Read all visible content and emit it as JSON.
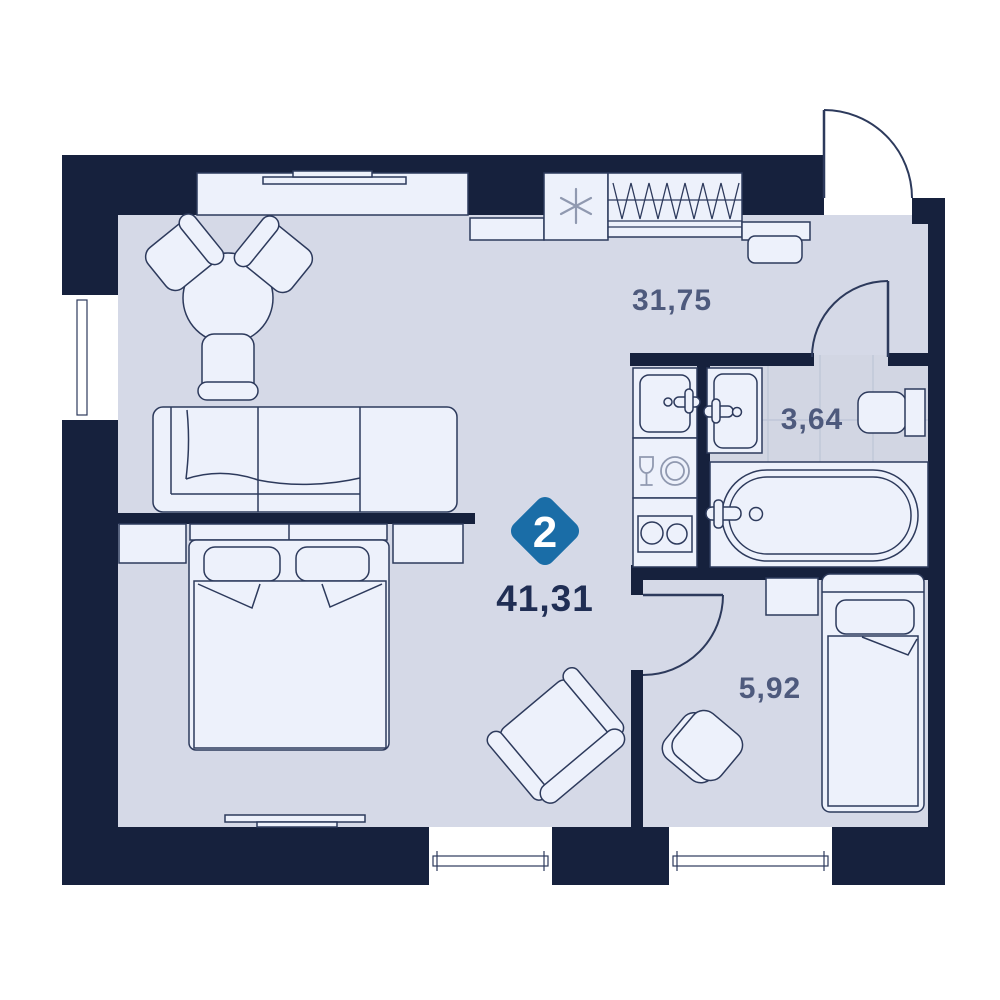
{
  "title": "2-room apartment floor plan",
  "badge": {
    "label": "2",
    "color": "#1a6da7",
    "text_color": "#ffffff"
  },
  "areas": {
    "total": "41,31",
    "living_kitchen": "31,75",
    "bathroom": "3,64",
    "small_room": "5,92"
  },
  "colors": {
    "wall": "#16213d",
    "floor": "#d5d9e7",
    "tile_floor": "#d2d6e3",
    "tile_grid": "#bdc4d6",
    "furniture": "#edf1fb",
    "outline": "#2d3a5c",
    "area_label_text": "#4e5a7d",
    "total_label_text": "#202e54",
    "icon_gray": "#9099b0",
    "window": "#ffffff",
    "background": "#ffffff"
  },
  "icons": {
    "freezer": "snowflake-asterisk",
    "wardrobe": "hanger-zigzag",
    "kitchen_counter": "wine-glass-and-plate",
    "cooktop": "two-burner-circles"
  }
}
